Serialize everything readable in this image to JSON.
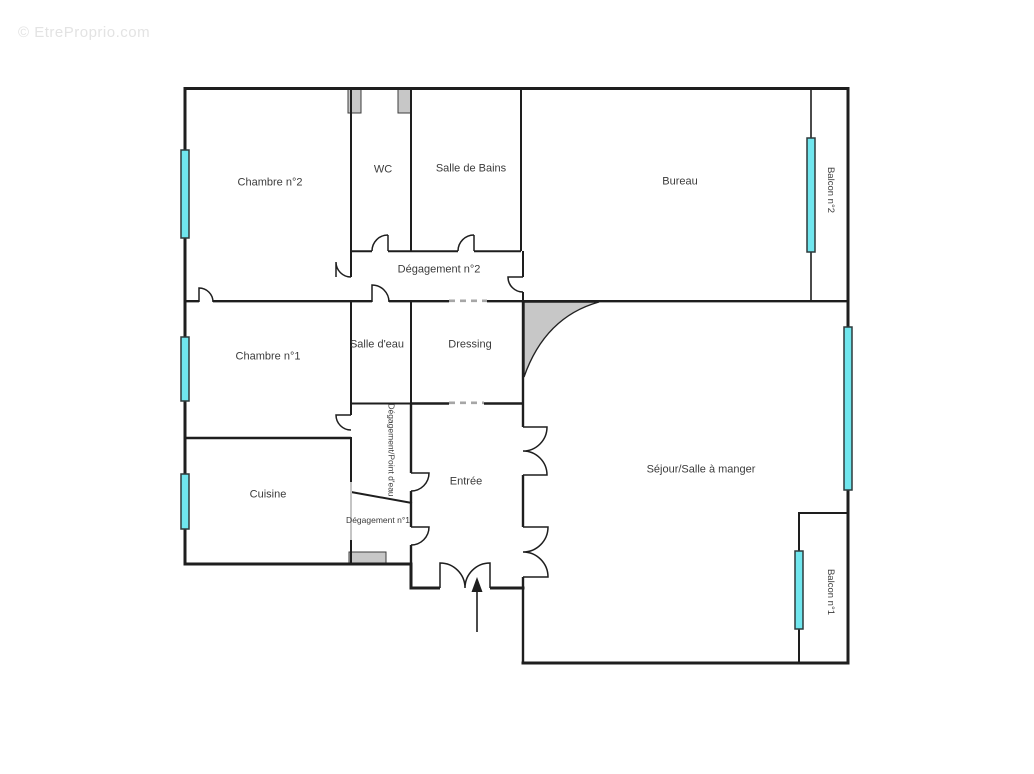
{
  "watermark": "© EtreProprio.com",
  "rooms": {
    "chambre2": "Chambre n°2",
    "wc": "WC",
    "salle_de_bains": "Salle de Bains",
    "bureau": "Bureau",
    "balcon2": "Balcon n°2",
    "degagement2": "Dégagement n°2",
    "chambre1": "Chambre n°1",
    "salle_deau": "Salle d'eau",
    "dressing": "Dressing",
    "sejour": "Séjour/Salle à manger",
    "cuisine": "Cuisine",
    "degagement_point_deau": "Dégagement/Point d'eau",
    "degagement1": "Dégagement n°1",
    "entree": "Entrée",
    "balcon1": "Balcon n°1"
  },
  "colors": {
    "wall": "#1e1e1e",
    "window_fill": "#70e6ee",
    "window_stroke": "#2e3a3c",
    "gray_fill": "#c7c7c7",
    "gray_wall": "#c4c4c4",
    "dash": "#a6a6a6",
    "label": "#3b3b3b",
    "watermark": "#e3e3e3"
  }
}
